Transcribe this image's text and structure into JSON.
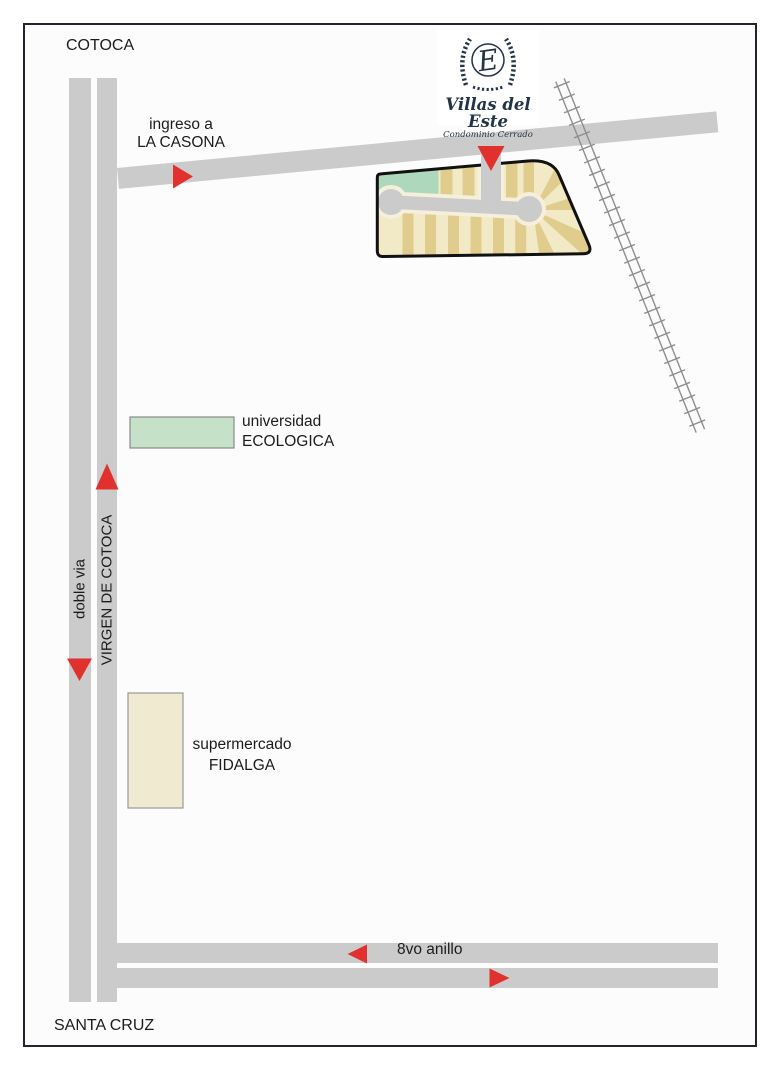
{
  "labels": {
    "cotoca": "COTOCA",
    "santa_cruz": "SANTA CRUZ",
    "doble_via": "doble via",
    "virgen_de_cotoca": "VIRGEN DE COTOCA",
    "ingreso_line1": "ingreso a",
    "ingreso_line2": "LA CASONA",
    "anillo": "8vo anillo"
  },
  "places": {
    "universidad_line1": "universidad",
    "universidad_line2": "ECOLOGICA",
    "supermercado_line1": "supermercado",
    "supermercado_line2": "FIDALGA"
  },
  "logo": {
    "monogram": "E",
    "name": "Villas del Este",
    "subtitle": "Condominio Cerrado"
  },
  "colors": {
    "road_gray": "#cbcbcb",
    "arrow_red": "#e0312e",
    "site_cream": "#f2e9c6",
    "site_tan": "#e0cd8e",
    "site_green": "#aed8bb",
    "site_road_casing": "#f5efdc",
    "university_green": "#c5e1c7",
    "building_border": "#8a8a8a",
    "logo_navy": "#233447",
    "frame_border": "#23232b",
    "railroad_gray": "#8f8f8f",
    "outline_black": "#111111"
  }
}
